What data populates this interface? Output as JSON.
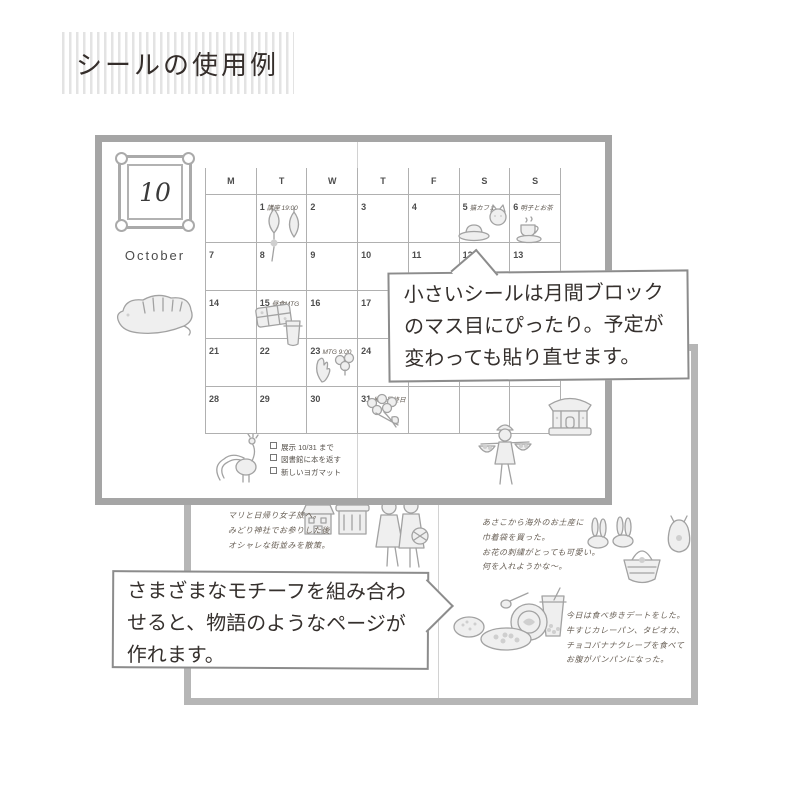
{
  "title": "シールの使用例",
  "colors": {
    "stripe": "#e3e3e3",
    "notebook_frame_top": "#a5a5a5",
    "notebook_frame_bottom": "#b6b6b6",
    "grid_line": "#b0b0b0",
    "bubble_border": "#8c8c8c",
    "text_dark": "#35302d"
  },
  "calendar": {
    "badge_month": "10",
    "month_name": "October",
    "weekday_headers": [
      "M",
      "T",
      "W",
      "T",
      "F",
      "S",
      "S"
    ],
    "weeks": [
      [
        {
          "date": "",
          "note": ""
        },
        {
          "date": "1",
          "note": "講座 19:00"
        },
        {
          "date": "2",
          "note": ""
        },
        {
          "date": "3",
          "note": ""
        },
        {
          "date": "4",
          "note": ""
        },
        {
          "date": "5",
          "note": "猫カフェ"
        },
        {
          "date": "6",
          "note": "明子とお茶"
        }
      ],
      [
        {
          "date": "7",
          "note": ""
        },
        {
          "date": "8",
          "note": ""
        },
        {
          "date": "9",
          "note": ""
        },
        {
          "date": "10",
          "note": ""
        },
        {
          "date": "11",
          "note": ""
        },
        {
          "date": "12",
          "note": ""
        },
        {
          "date": "13",
          "note": ""
        }
      ],
      [
        {
          "date": "14",
          "note": ""
        },
        {
          "date": "15",
          "note": "昼食MTG"
        },
        {
          "date": "16",
          "note": ""
        },
        {
          "date": "17",
          "note": ""
        },
        {
          "date": "18",
          "note": ""
        },
        {
          "date": "19",
          "note": ""
        },
        {
          "date": "20",
          "note": ""
        }
      ],
      [
        {
          "date": "21",
          "note": ""
        },
        {
          "date": "22",
          "note": ""
        },
        {
          "date": "23",
          "note": "MTG 9:00"
        },
        {
          "date": "24",
          "note": ""
        },
        {
          "date": "25",
          "note": ""
        },
        {
          "date": "26",
          "note": ""
        },
        {
          "date": "27",
          "note": ""
        }
      ],
      [
        {
          "date": "28",
          "note": ""
        },
        {
          "date": "29",
          "note": ""
        },
        {
          "date": "30",
          "note": ""
        },
        {
          "date": "31",
          "note": "展示最終日"
        },
        {
          "date": "",
          "note": ""
        },
        {
          "date": "",
          "note": ""
        },
        {
          "date": "",
          "note": ""
        }
      ]
    ],
    "checklist": [
      "展示 10/31 まで",
      "図書館に本を返す",
      "新しいヨガマット"
    ]
  },
  "bubbles": {
    "monthly_block": "小さいシールは月間ブロック\nのマス目にぴったり。予定が\n変わっても貼り直せます。",
    "motif_story": "さまざまなモチーフを組み合わ\nせると、物語のようなページが\n作れます。"
  },
  "journal": {
    "trip_note": "マリと日帰り女子旅へ。\nみどり神社でお参りした後\nオシャレな街並みを散策。",
    "souvenir_note": "あさこから海外のお土産に\n巾着袋を買った。\nお花の刺繍がとっても可愛い。\n何を入れようかな〜。",
    "food_note": "今日は食べ歩きデートをした。\n牛すじカレーパン、タピオカ、\nチョコバナナクレープを食べて\nお腹がパンパンになった。"
  },
  "stickers": {
    "month_badge": "ornate-frame",
    "calendar_page": [
      "tiger",
      "paper-lanterns",
      "cake-plate",
      "cat",
      "teacup",
      "bento-box",
      "drink-cup",
      "leaf-plant",
      "berry-plant",
      "flower-bouquet",
      "peacock",
      "temple-building",
      "basket-vendor"
    ],
    "journal_page": [
      "houses",
      "strolling-couple",
      "bunny-slippers",
      "basket-bag",
      "drawstring-pouch",
      "spoon",
      "tapioca-drink",
      "round-plate",
      "food-plate",
      "curry-bread"
    ]
  }
}
